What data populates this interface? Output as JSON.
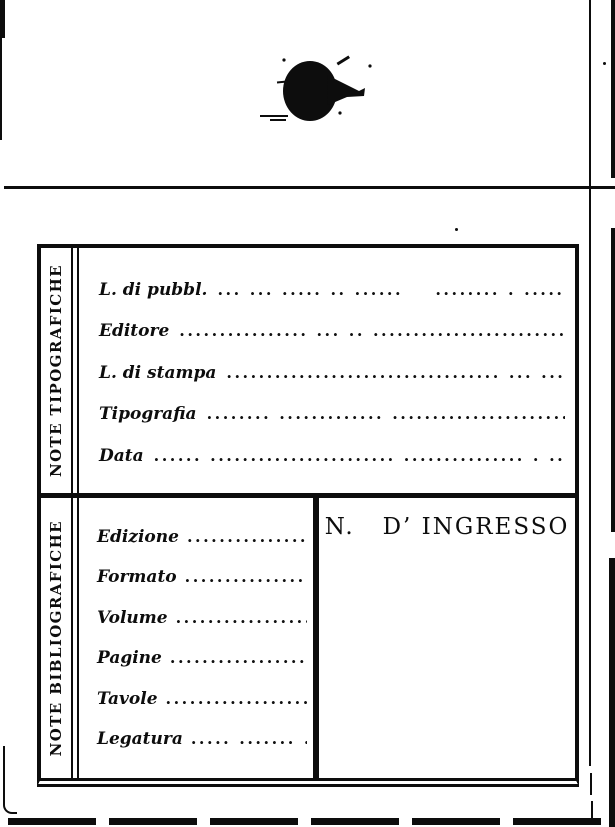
{
  "colors": {
    "ink": "#0d0d0d",
    "paper": "#ffffff"
  },
  "stamp": {
    "name": "ink-blot"
  },
  "card": {
    "sections": [
      {
        "side_label": "NOTE TIPOGRAFICHE",
        "fields": [
          {
            "label": "L. di pubbl.",
            "dots": "... ... ..... .. ......    ........ . .........."
          },
          {
            "label": "Editore",
            "dots": "................ ... .. ..........................."
          },
          {
            "label": "L. di stampa",
            "dots": ".................................. ... ......"
          },
          {
            "label": "Tipografia",
            "dots": "........ ............. .........................."
          },
          {
            "label": "Data",
            "dots": "...... ....................... ............... . .. .. ..."
          }
        ]
      },
      {
        "side_label": "NOTE BIBLIOGRAFICHE",
        "ingresso_label": "N.   D’ INGRESSO",
        "fields": [
          {
            "label": "Edizione",
            "dots": "...................."
          },
          {
            "label": "Formato",
            "dots": "....................."
          },
          {
            "label": "Volume",
            "dots": "......................"
          },
          {
            "label": "Pagine",
            "dots": "....................."
          },
          {
            "label": "Tavole",
            "dots": "......................"
          },
          {
            "label": "Legatura",
            "dots": "..... ....... ......"
          }
        ]
      }
    ]
  }
}
